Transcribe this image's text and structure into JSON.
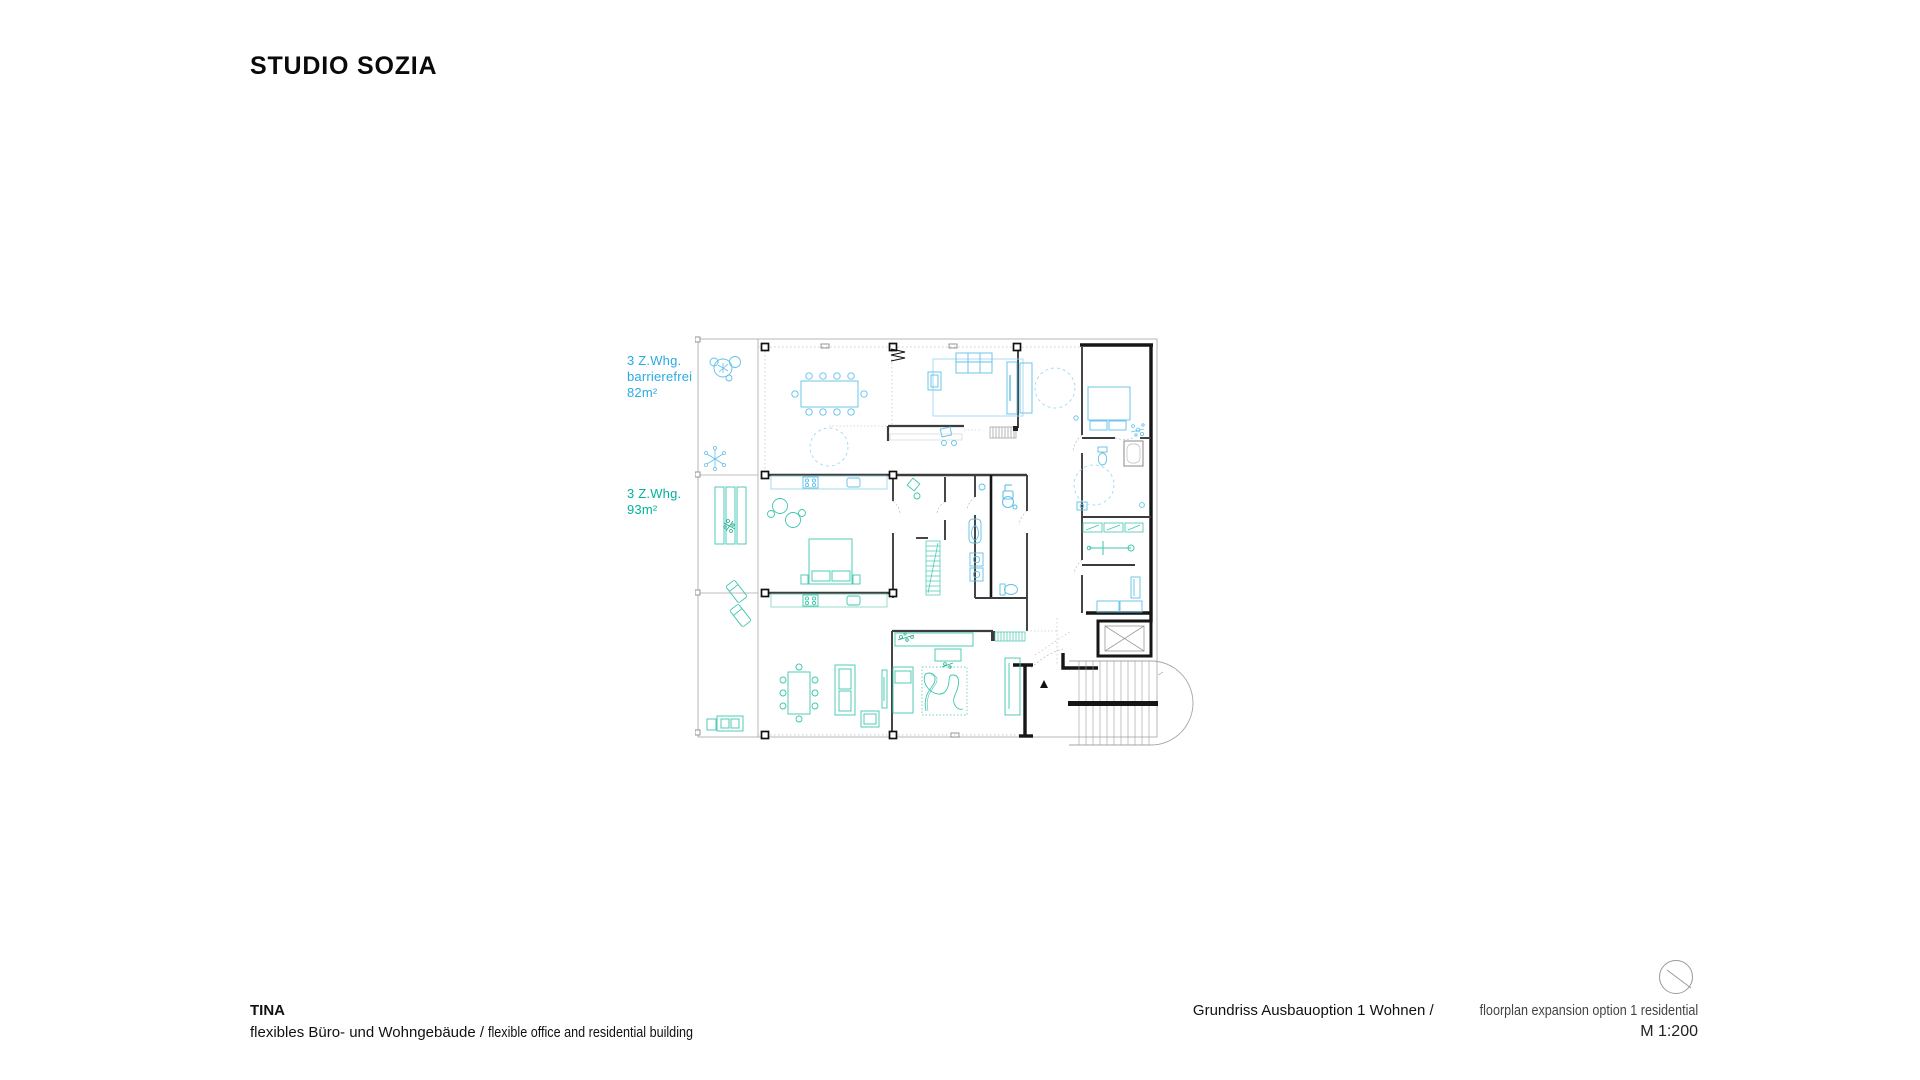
{
  "header": {
    "logo": "STUDIO SOZIA"
  },
  "plan": {
    "labels": [
      {
        "line1": "3 Z.Whg.",
        "line2": "barrierefrei",
        "line3": "82m²",
        "color": "#29ABE2"
      },
      {
        "line1": "3 Z.Whg.",
        "line2": "93m²",
        "color": "#00B398"
      }
    ]
  },
  "footer": {
    "left": {
      "title": "TINA",
      "subtitle_de": "flexibles Büro- und Wohngebäude",
      "separator": " / ",
      "subtitle_en": "flexible office and residential building"
    },
    "right": {
      "title_de": "Grundriss Ausbauoption 1 Wohnen",
      "separator": " / ",
      "title_en": "floorplan expansion option 1 residential",
      "scale": "M 1:200"
    }
  },
  "colors": {
    "accent_blue": "#29ABE2",
    "accent_teal": "#00B398",
    "furniture_blue": "#5FC0E8",
    "furniture_blue_light": "#9ED9F2",
    "furniture_teal": "#3EC6AD",
    "plant_teal": "#1FAE8E",
    "wall_black": "#161616",
    "wall_gray": "#3C3C3C",
    "outline_gray": "#A6A6A6"
  }
}
